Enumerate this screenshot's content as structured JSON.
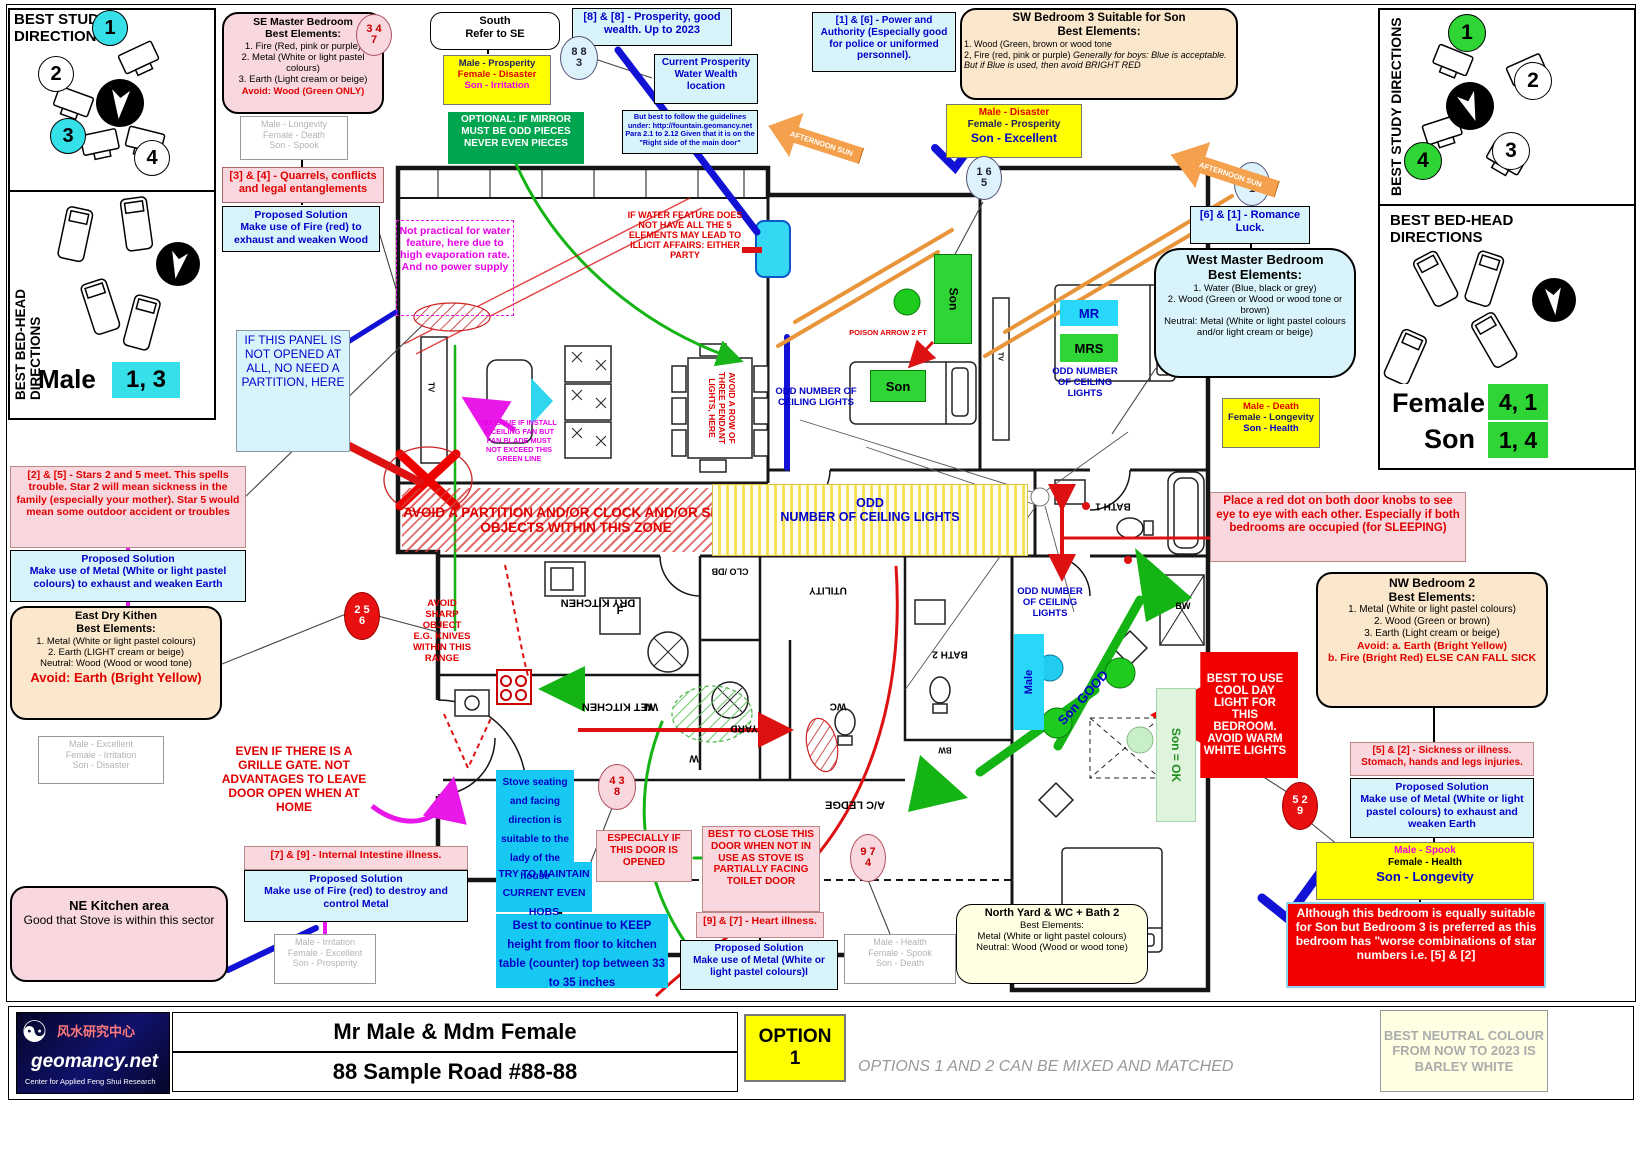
{
  "left_study": {
    "title": "BEST STUDY DIRECTIONS",
    "n1": "1",
    "n2": "2",
    "n3": "3",
    "n4": "4"
  },
  "left_bed": {
    "title": "BEST BED-HEAD DIRECTIONS",
    "name": "Male",
    "vals": "1, 3"
  },
  "right_study": {
    "title": "BEST STUDY DIRECTIONS",
    "n1": "1",
    "n2": "2",
    "n3": "3",
    "n4": "4"
  },
  "right_bed": {
    "title": "BEST BED-HEAD DIRECTIONS",
    "f_name": "Female",
    "f_vals": "4, 1",
    "s_name": "Son",
    "s_vals": "1, 4"
  },
  "b": {
    "se": {
      "t1": "SE Master Bedroom",
      "t2": "Best Elements:",
      "i1": "1. Fire (Red, pink or purple)",
      "i2": "2. Metal (White or light pastel colours)",
      "i3": "3. Earth (Light cream or beige)",
      "avoid": "Avoid: Wood (Green ONLY)"
    },
    "b347": {
      "a": "3 4",
      "b": "7"
    },
    "out_se": {
      "m": "Male -  Longevity",
      "f": "Female -  Death",
      "s": "Son -  Spook"
    },
    "quarrels": "[3] & [4] - Quarrels, conflicts and legal entanglements",
    "sol_q": {
      "t": "Proposed Solution",
      "b": "Make use of Fire (red) to exhaust and weaken Wood"
    },
    "south": {
      "t1": "South",
      "t2": "Refer to SE"
    },
    "out_south": {
      "m": "Male -  Prosperity",
      "f": "Female -  Disaster",
      "s": "Son -  Irritation"
    },
    "mirror": "OPTIONAL: IF MIRROR MUST BE ODD PIECES NEVER EVEN PIECES",
    "p88": "[8] & [8] - Prosperity, good wealth. Up to 2023",
    "b883": {
      "a": "8 8",
      "b": "3"
    },
    "curr": "Current Prosperity Water Wealth location",
    "guide": "But best to follow the guidelines under: http://fountain.geomancy.net Para 2.1 to 2.12 Given that it is on the \"Right side of the main door\"",
    "p16": "[1] & [6] - Power and Authority (Especially good for police or uniformed personnel).",
    "sw": {
      "t1": "SW  Bedroom 3 Suitable for Son",
      "t2": "Best Elements:",
      "i1": "1.  Wood (Green, brown or wood tone",
      "i2a": "2, Fire (red, pink or purple) ",
      "i2b": "Generally for boys: Blue is acceptable.",
      "i3": "But if Blue is used, then avoid BRIGHT RED"
    },
    "out_sw": {
      "m": "Male -  Disaster",
      "f": "Female -  Prosperity",
      "s": "Son -  Excellent"
    },
    "b165": {
      "a": "1 6",
      "b": "5"
    },
    "b611": {
      "a": "6 1",
      "b": "1"
    },
    "romance": "[6] & [1] - Romance Luck.",
    "west": {
      "t1": "West Master Bedroom",
      "t2": "Best Elements:",
      "i1": "1. Water (Blue, black or grey)",
      "i2": "2. Wood (Green or Wood or wood tone or brown)",
      "i3": "Neutral: Metal (White or light pastel colours and/or light cream or beige)"
    },
    "out_west": {
      "m": "Male -  Death",
      "f": "Female -  Longevity",
      "s": "Son -  Health"
    },
    "red_dot": "Place a red dot on both door knobs to see eye to eye with each other. Especially if both bedrooms are occupied (for SLEEPING)",
    "nw": {
      "t1": "NW Bedroom 2",
      "t2": "Best Elements:",
      "i1": "1. Metal (White or light pastel colours)",
      "i2": "2. Wood (Green or brown)",
      "i3": "3. Earth (Light cream or beige)",
      "a1": "Avoid: a. Earth (Bright Yellow)",
      "a2": "b. Fire (Bright Red)  ELSE CAN FALL SICK"
    },
    "cool": "BEST TO USE COOL DAY LIGHT FOR THIS BEDROOM. AVOID WARM WHITE LIGHTS",
    "s52": "[5] & [2] - Sickness or illness. Stomach, hands and legs injuries.",
    "sol52": {
      "t": "Proposed Solution",
      "b": "Make use of Metal (White or light pastel colours) to exhaust and weaken Earth"
    },
    "b529": {
      "a": "5 2",
      "b": "9"
    },
    "out_nw": {
      "m": "Male -  Spook",
      "f": "Female -  Health",
      "s": "Son -  Longevity"
    },
    "although": "Although this bedroom is equally suitable for Son but Bedroom 3 is preferred as this bedroom has \"worse combinations of star numbers i.e. [5] & [2]",
    "yard": {
      "t1": "North Yard & WC + Bath 2",
      "t2": "Best Elements:",
      "i1": "Metal (White or light pastel colours)",
      "i2": "Neutral: Wood (Wood or wood tone)"
    },
    "out_n": {
      "m": "Male -  Health",
      "f": "Female -  Spook",
      "s": "Son -  Death"
    },
    "h97": "[9] & [7] - Heart illness.",
    "sol97": {
      "t": "Proposed Solution",
      "b": "Make use of Metal (White or light pastel colours)l"
    },
    "out_ne": {
      "m": "Male -  Irritation",
      "f": "Female -  Excellent",
      "s": "Son -  Prosperity"
    },
    "ne": {
      "t": "NE Kitchen area",
      "b": "Good that Stove is within this sector"
    },
    "i79": "[7] & [9] - Internal Intestine illness.",
    "sol79": {
      "t": "Proposed Solution",
      "b": "Make use of Fire (red) to destroy and control Metal"
    },
    "grille": "EVEN IF THERE IS A GRILLE GATE. NOT ADVANTAGES TO LEAVE DOOR OPEN WHEN AT HOME",
    "stove": "Stove seating and facing direction is suitable to the lady of the house",
    "hobs": "TRY TO MAINTAIN CURRENT EVEN HOBS",
    "counter": "Best to continue to KEEP height from floor to kitchen table (counter) top between 33 to 35 inches",
    "esp": "ESPECIALLY IF THIS DOOR IS OPENED",
    "close": "BEST TO CLOSE THIS DOOR WHEN NOT IN USE AS STOVE IS PARTIALLY FACING TOILET DOOR",
    "b438": {
      "a": "4 3",
      "b": "8"
    },
    "b974": {
      "a": "9 7",
      "b": "4"
    },
    "stars": "[2] & [5] - Stars 2 and 5 meet. This spells trouble. Star 2 will mean sickness in the family (especially your mother). Star 5 would mean some outdoor accident or troubles",
    "sol25": {
      "t": "Proposed Solution",
      "b": "Make use of Metal (White or light pastel colours) to exhaust and weaken Earth"
    },
    "east": {
      "t1": "East Dry Kithen",
      "t2": "Best Elements:",
      "i1": "1. Metal (White or light pastel colours)",
      "i2": "2. Earth (LIGHT cream or beige)",
      "i3": "Neutral: Wood (Wood or wood tone)",
      "avoid": "Avoid: Earth (Bright Yellow)"
    },
    "out_e": {
      "m": "Male -  Excellent",
      "f": "Female -  Irritation",
      "s": "Son -  Disaster"
    },
    "b256": {
      "a": "2 5",
      "b": "6"
    },
    "water": "Not practical for water feature, here due to high evaporation rate. And no power supply",
    "illicit": "IF WATER FEATURE DOES NOT HAVE ALL THE 5 ELEMENTS MAY LEAD TO ILLICIT AFFAIRS: EITHER PARTY",
    "panel": "IF THIS PANEL IS NOT OPENED AT ALL, NO NEED A PARTITION, HERE",
    "fan": "NO ISSUE IF INSTALL A CEILING FAN BUT FAN BLADE MUST NOT EXCEED THIS GREEN LINE",
    "partition": "AVOID A PARTITION AND/OR CLOCK AND/OR SHARP OBJECTS WITHIN THIS ZONE",
    "odd_main": {
      "t1": "ODD",
      "t2": "NUMBER OF CEILING LIGHTS"
    },
    "sharp": "AVOID SHARP OBJECT E.G. KNIVES WITHIN THIS RANGE",
    "pendant": "AVOID A ROW OF THREE PENDANT LIGHTS, HERE",
    "poison": "POISON ARROW 2 FT",
    "odd_small": "ODD NUMBER OF CEILING LIGHTS",
    "son_good": "Son GOOD",
    "son_ok": "Son = OK",
    "male_tag": "Male",
    "son_tag": "Son",
    "mr": "MR",
    "mrs": "MRS",
    "sun": "AFTERNOON SUN"
  },
  "lab": {
    "dry": "DRY KITCHEN",
    "wet": "WET KITCHEN",
    "yard": "YARD",
    "utility": "UTILITY",
    "wc": "WC",
    "bath2": "BATH 2",
    "bath1": "BATH 1",
    "ac": "A/C LEDGE",
    "clo": "CLO /DB",
    "f": "F",
    "w": "W",
    "m": "M",
    "tv": "TV",
    "bw": "BW"
  },
  "footer": {
    "chinese": "风水研究中心",
    "brand": "geomancy.net",
    "tagline": "Center for Applied Feng Shui Research",
    "client": "Mr Male & Mdm Female",
    "address": "88 Sample Road #88-88",
    "option_1": "OPTION",
    "option_2": "1",
    "mixed": "OPTIONS 1 AND 2 CAN BE MIXED AND MATCHED",
    "neutral": "BEST NEUTRAL COLOUR FROM NOW TO 2023 IS BARLEY WHITE"
  }
}
